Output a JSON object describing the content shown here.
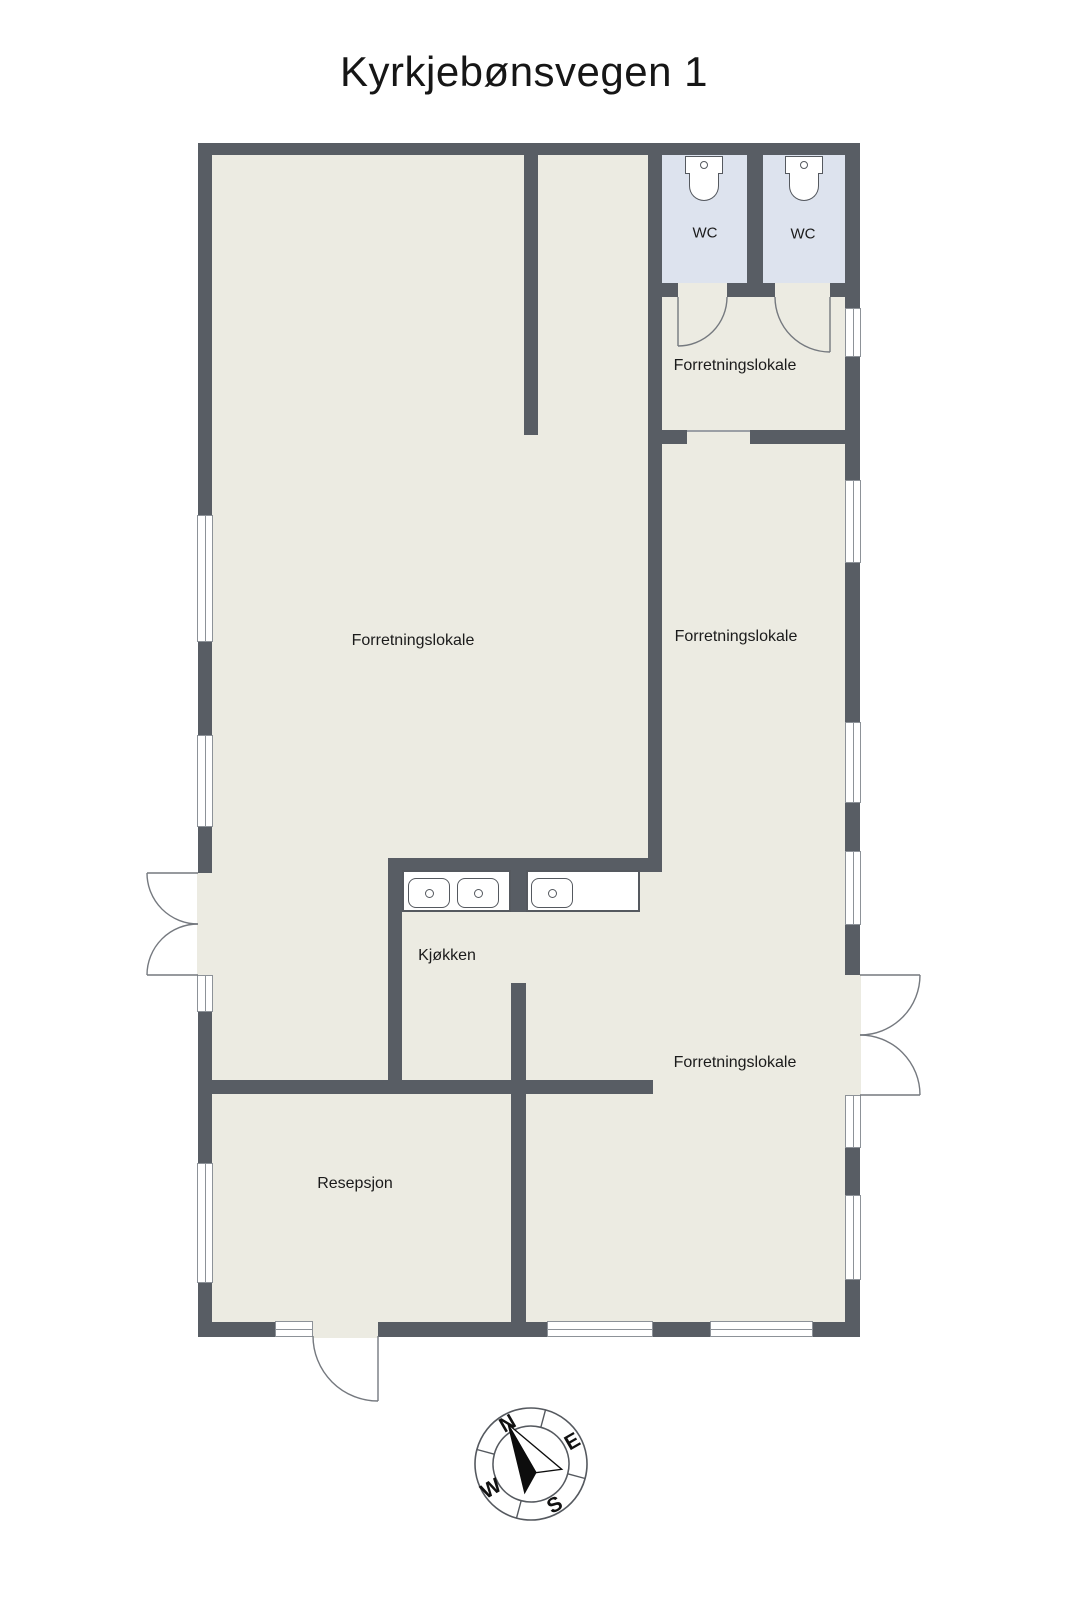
{
  "title": "Kyrkjebønsvegen 1",
  "rooms": {
    "main": "Forretningslokale",
    "upper_right": "Forretningslokale",
    "middle_right": "Forretningslokale",
    "lower_right": "Forretningslokale",
    "kitchen": "Kjøkken",
    "reception": "Resepsjon",
    "wc1": "WC",
    "wc2": "WC"
  },
  "compass": {
    "n": "N",
    "e": "E",
    "s": "S",
    "w": "W"
  },
  "colors": {
    "background": "#ffffff",
    "wall": "#585d64",
    "floor": "#ecebe2",
    "wc_floor": "#dde3ee",
    "fixture_outline": "#55595f",
    "window_frame": "#8d9298"
  }
}
